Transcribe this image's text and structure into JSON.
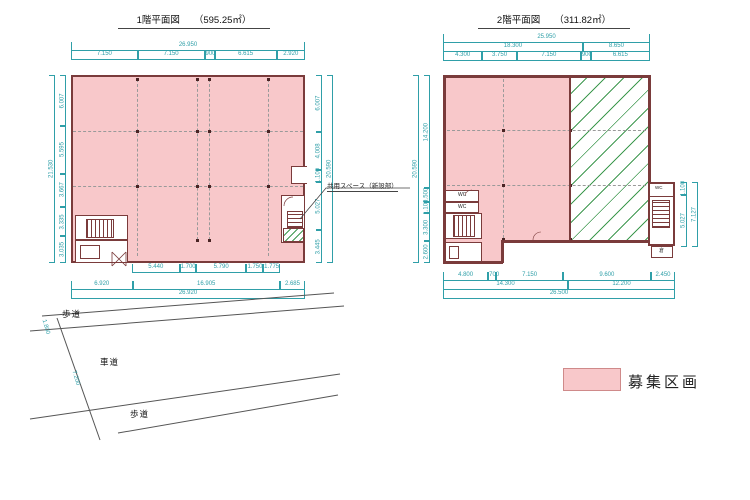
{
  "colors": {
    "available_fill": "#f8c8ca",
    "wall": "#7a3b3b",
    "unavailable_hatch": "#3f9950",
    "dimension": "#2f9fa8"
  },
  "floor1": {
    "title": "1階平面図",
    "area": "（595.25㎡）",
    "dims": {
      "top_total": [
        "26.950"
      ],
      "top": [
        "7.150",
        "7.150",
        "900",
        "6.615",
        "2.920"
      ],
      "left_total": [
        "21.530"
      ],
      "left": [
        "6.007",
        "5.595",
        "3.667",
        "3.335",
        "3.035"
      ],
      "right": [
        "6.007",
        "4.008",
        "1.100",
        "5.027",
        "3.445"
      ],
      "right_total": [
        "20.590"
      ],
      "bottom_inner": [
        "5.440",
        "1.700",
        "5.790",
        "1.750",
        "1.775"
      ],
      "bottom": [
        "6.920",
        "16.905",
        "2.685"
      ],
      "bottom_total": [
        "26.920"
      ]
    },
    "labels": {
      "shared_space": "共用スペース（新設部）"
    }
  },
  "floor2": {
    "title": "2階平面図",
    "area": "（311.82㎡）",
    "dims": {
      "top_total": [
        "25.950"
      ],
      "top_mid": [
        "18.300",
        "8.650"
      ],
      "top": [
        "4.300",
        "3.750",
        "7.150",
        "900",
        "6.615"
      ],
      "left_total": [
        "20.590"
      ],
      "left": [
        "14.200",
        "1.500",
        "1.100",
        "3.300",
        "2.600"
      ],
      "right": [
        "1.100",
        "5.027"
      ],
      "right_total": [
        "7.127"
      ],
      "bottom": [
        "4.800",
        "700",
        "7.150",
        "9.600",
        "2.450"
      ],
      "bottom_mid": [
        "14.300",
        "12.200"
      ],
      "bottom_total": [
        "26.500"
      ]
    },
    "labels": {
      "wc1": "WC",
      "wc2": "WC",
      "wc_annex": "WC",
      "store": "倉"
    }
  },
  "site": {
    "road_top": "歩道",
    "road_mid": "車道",
    "road_bottom": "歩道",
    "dims": [
      "1.800",
      "7.200"
    ]
  },
  "legend": {
    "label": "募集区画"
  }
}
